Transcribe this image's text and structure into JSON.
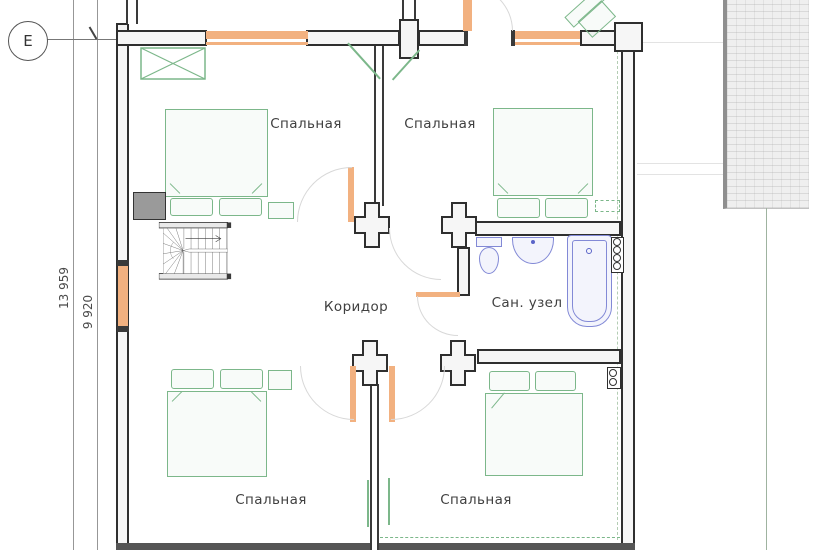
{
  "axis_marker": {
    "label": "Е"
  },
  "dimensions": {
    "outer": "13 959",
    "inner": "9 920"
  },
  "rooms": {
    "bedroom_top_left": {
      "label": "Спальная"
    },
    "bedroom_top_right": {
      "label": "Спальная"
    },
    "corridor": {
      "label": "Коридор"
    },
    "bathroom": {
      "label": "Сан. узел"
    },
    "bedroom_bottom_left": {
      "label": "Спальная"
    },
    "bedroom_bottom_right": {
      "label": "Спальная"
    }
  },
  "legend_colors": {
    "walls": "#2f2f2f",
    "furniture_green": "#7cb78a",
    "plumbing_blue": "#8289d6",
    "window_orange": "#f2b180",
    "door_arc_gray": "#d8d8d8"
  }
}
